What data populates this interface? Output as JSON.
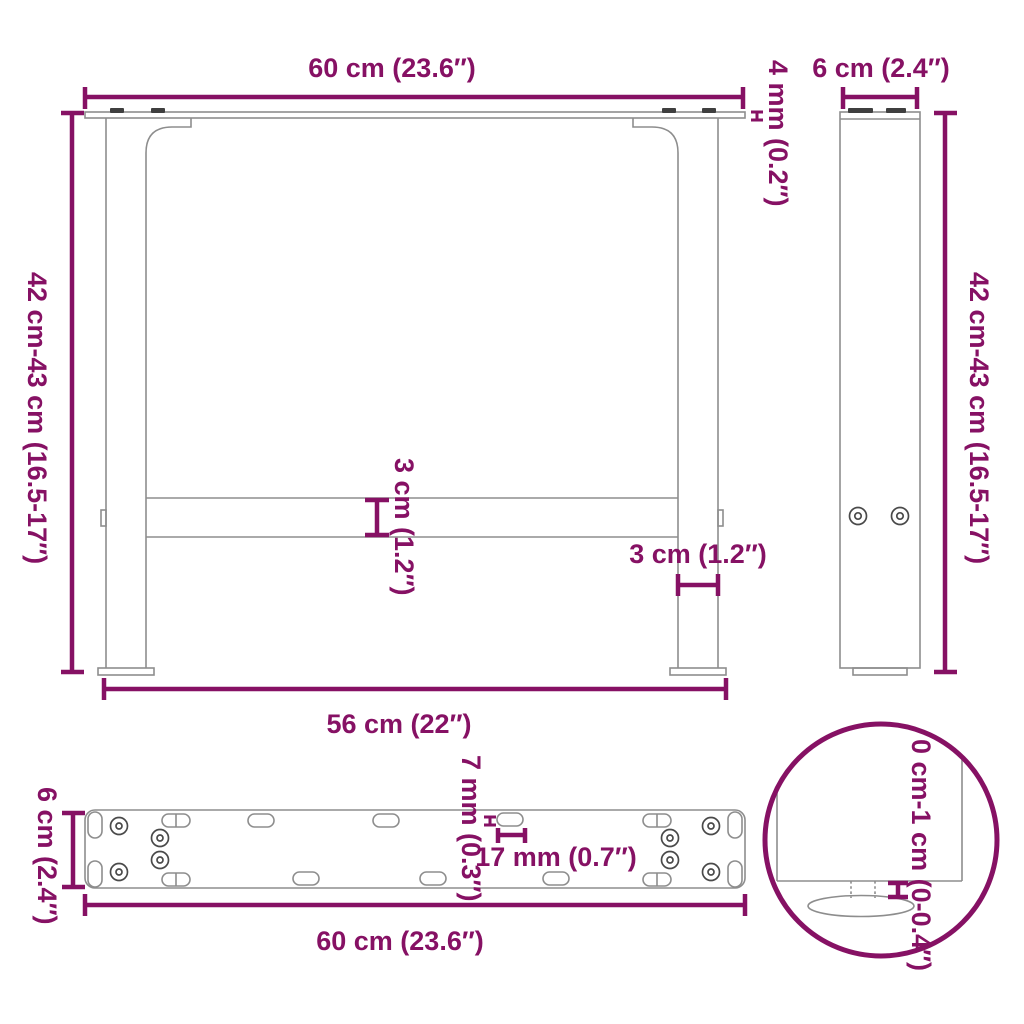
{
  "meta": {
    "title": "table-legs-dimension-diagram"
  },
  "colors": {
    "dimension_accent": "#861164",
    "drawing_line": "#8d8d8d",
    "drawing_dark": "#3f3f3f",
    "background": "#ffffff"
  },
  "labels": {
    "front_top_width": "60 cm (23.6″)",
    "front_plate_thickness": "4 mm (0.2″)",
    "front_height": "42 cm-43 cm (16.5-17″)",
    "front_crossbar_thickness": "3 cm (1.2″)",
    "front_leg_width": "3 cm (1.2″)",
    "front_bottom_width": "56 cm (22″)",
    "side_width": "6 cm (2.4″)",
    "side_height": "42 cm-43 cm (16.5-17″)",
    "top_depth": "6 cm (2.4″)",
    "top_slot_width": "7 mm (0.3″)",
    "top_slot_length": "17 mm (0.7″)",
    "top_length": "60 cm (23.6″)",
    "detail_adjustable_height": "0 cm-1 cm (0-0.4″)"
  }
}
